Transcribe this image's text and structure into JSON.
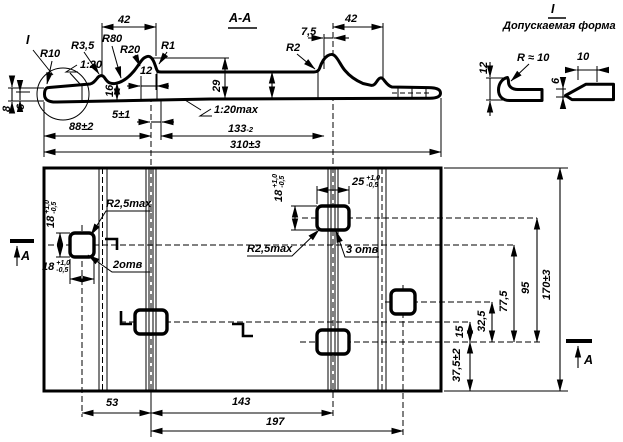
{
  "section": {
    "title": "А-А",
    "callout_ref": "I",
    "r10": "R10",
    "r3_5": "R3,5",
    "r80": "R80",
    "r20": "R20",
    "r1": "R1",
    "r2": "R2",
    "slope_top": "1:20",
    "slope_bottom": "1:20max",
    "d42_left": "42",
    "d42_right": "42",
    "d7_5": "7,5",
    "d12": "12",
    "d16": "16",
    "d29": "29",
    "d8": "8",
    "d6": "6",
    "d5": "5±1",
    "d88": "88±2",
    "d133": {
      "v": "133",
      "sup": "-2"
    },
    "d310": "310±3"
  },
  "detail": {
    "ref": "I",
    "title": "Допускаемая форма",
    "d12": "12",
    "r10": "R ≈ 10",
    "d10": "10",
    "d6": "6"
  },
  "plan": {
    "section_arrow_left": "А",
    "section_arrow_right": "А",
    "hole_small_h": {
      "v": "18",
      "plus": "+1,0",
      "minus": "-0,5"
    },
    "hole_small_w": {
      "v": "18",
      "plus": "+1,0",
      "minus": "-0,5"
    },
    "hole_big_h": {
      "v": "18",
      "plus": "+1,0",
      "minus": "-0,5"
    },
    "hole_big_w": {
      "v": "25",
      "plus": "+1,0",
      "minus": "-0,5"
    },
    "hole_small_count": "2отв",
    "hole_big_count": "3 отв",
    "hole_radius_left": "R2,5max",
    "hole_radius_mid": "R2,5max",
    "d53": "53",
    "d143": "143",
    "d197": "197",
    "d37_5": "37,5±2",
    "d15": "15",
    "d32_5": "32,5",
    "d77_5": "77,5",
    "d95": "95",
    "d170": "170±3"
  }
}
